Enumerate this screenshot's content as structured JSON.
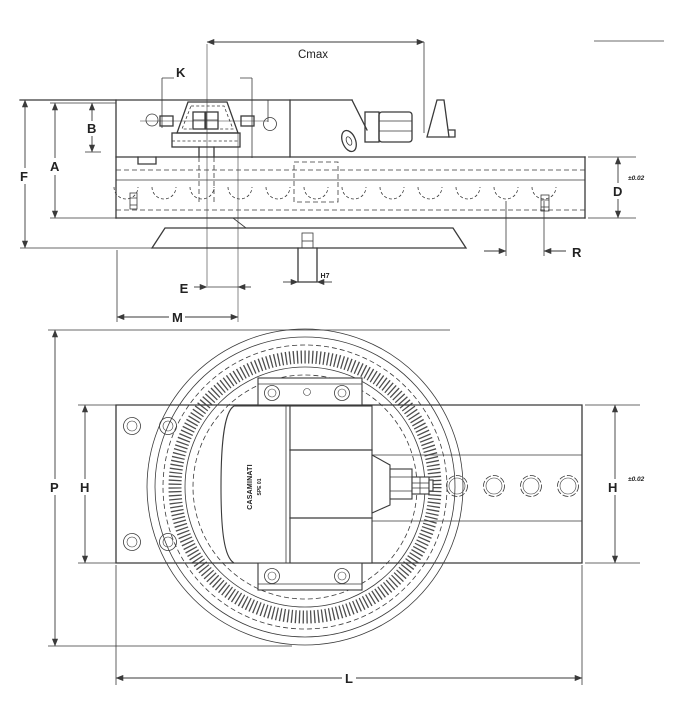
{
  "page": {
    "background": "#ffffff",
    "line_color": "#3a3a3a"
  },
  "drawing": {
    "side_view": {
      "dim_f": "F",
      "dim_a": "A",
      "dim_b": "B",
      "dim_k": "K",
      "dim_cmax": "Cmax",
      "dim_e": "E",
      "dim_m": "M",
      "dim_h7": "H7",
      "dim_d": "D",
      "tol_d": "±0.02",
      "dim_r": "R"
    },
    "plan_view": {
      "dim_p": "P",
      "dim_h_left": "H",
      "dim_h_right": "H",
      "tol_h": "±0.02",
      "dim_l": "L",
      "brand_line1": "CASAMINATI",
      "brand_line2": "SPE 01"
    }
  }
}
